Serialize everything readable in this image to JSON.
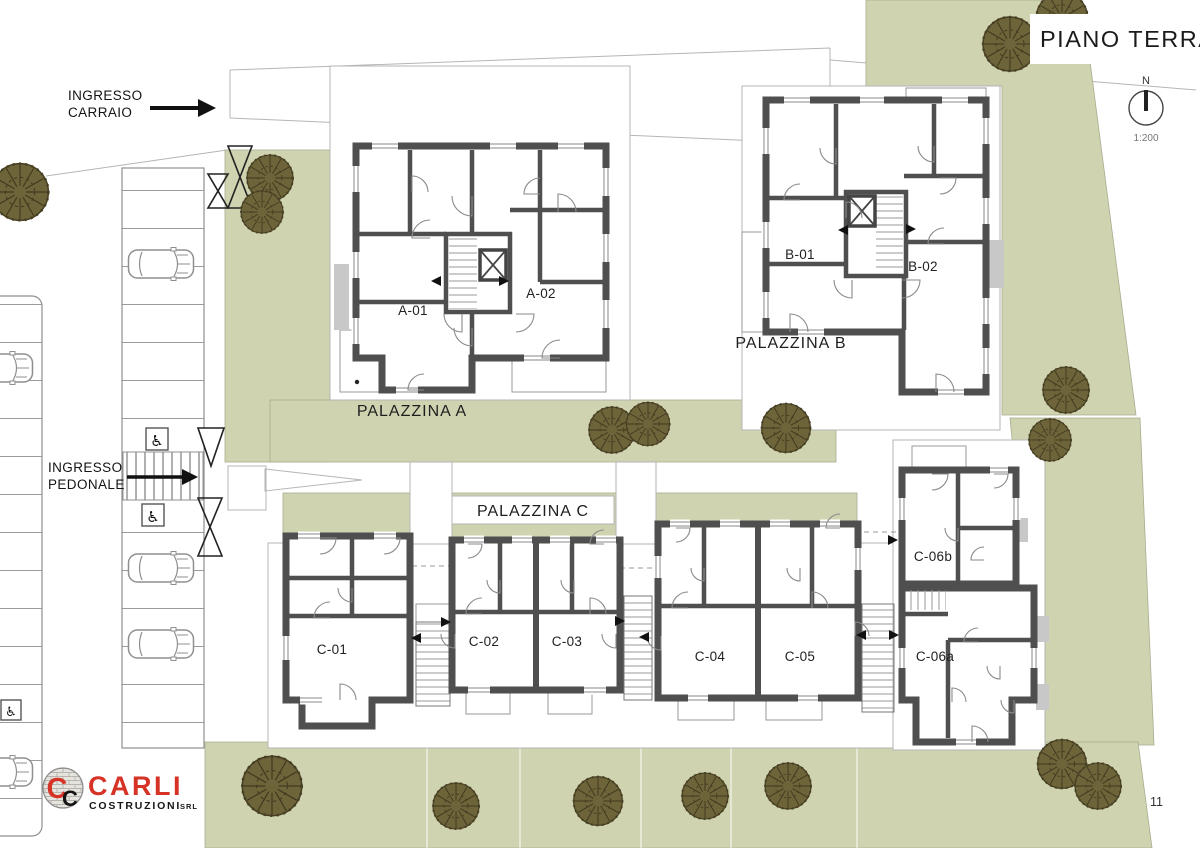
{
  "title": "PIANO TERRA",
  "north": {
    "label": "N",
    "scale": "1:200"
  },
  "entrances": {
    "carraio": [
      "INGRESSO",
      "CARRAIO"
    ],
    "pedonale": [
      "INGRESSO",
      "PEDONALE"
    ]
  },
  "buildings": [
    {
      "name": "PALAZZINA A",
      "units": [
        "A-01",
        "A-02"
      ]
    },
    {
      "name": "PALAZZINA B",
      "units": [
        "B-01",
        "B-02"
      ]
    },
    {
      "name": "PALAZZINA C",
      "units": [
        "C-01",
        "C-02",
        "C-03",
        "C-04",
        "C-05",
        "C-06a",
        "C-06b"
      ]
    }
  ],
  "logo": {
    "monogram": "C",
    "brand": "CARLI",
    "sub": "COSTRUZIONI",
    "suffix": "SRL"
  },
  "icons": {
    "accessible": "♿"
  },
  "page_number": "11",
  "colors": {
    "green": "#cfd3b0",
    "wall": "#4f4f4f",
    "tree": "#6e643a",
    "accent_red": "#d63226"
  }
}
